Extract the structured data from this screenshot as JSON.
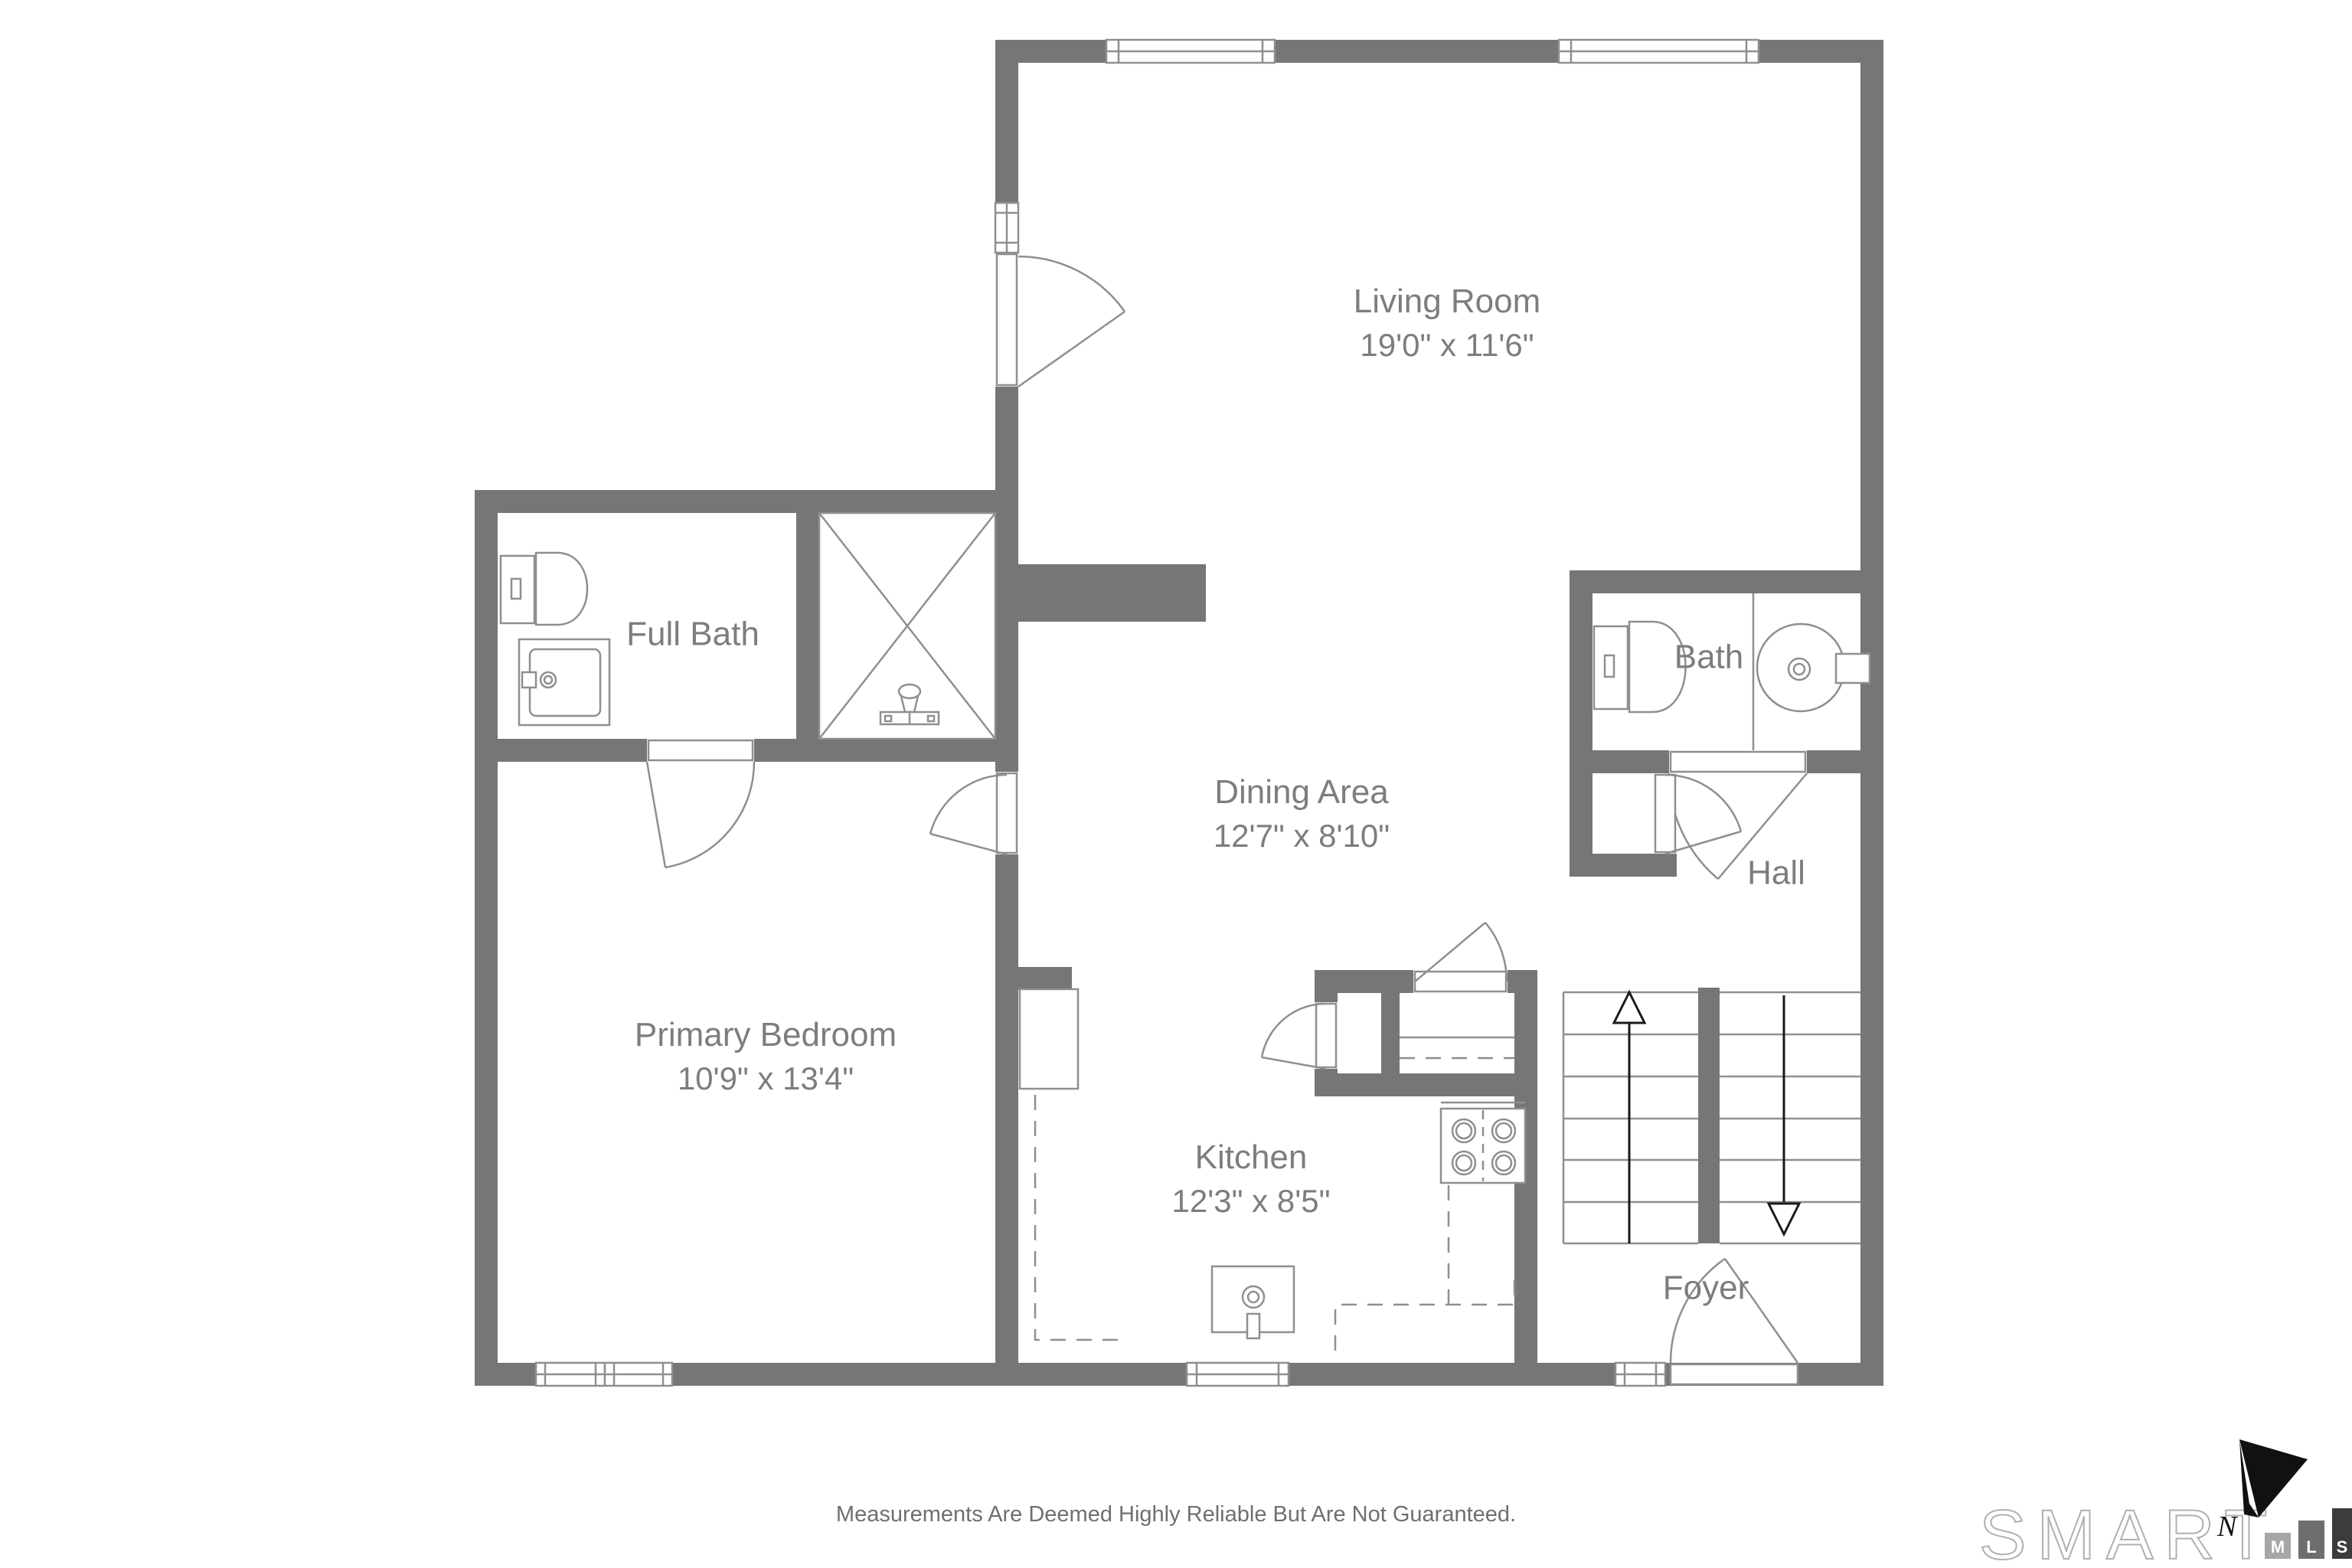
{
  "rooms": [
    {
      "id": "living-room",
      "name": "Living Room",
      "dims": "19'0\" x 11'6\""
    },
    {
      "id": "full-bath",
      "name": "Full Bath",
      "dims": ""
    },
    {
      "id": "dining-area",
      "name": "Dining Area",
      "dims": "12'7\" x 8'10\""
    },
    {
      "id": "bath",
      "name": "Bath",
      "dims": ""
    },
    {
      "id": "hall",
      "name": "Hall",
      "dims": ""
    },
    {
      "id": "primary-bedroom",
      "name": "Primary Bedroom",
      "dims": "10'9\" x 13'4\""
    },
    {
      "id": "kitchen",
      "name": "Kitchen",
      "dims": "12'3\" x 8'5\""
    },
    {
      "id": "foyer",
      "name": "Foyer",
      "dims": ""
    }
  ],
  "footer": {
    "disclaimer": "Measurements Are Deemed Highly Reliable But Are Not Guaranteed."
  },
  "logo": {
    "brand": "SMART",
    "letters": [
      "M",
      "L",
      "S"
    ],
    "north": "N"
  },
  "colors": {
    "wall": "#767676",
    "fixture_line": "#8f8f8f",
    "label_text": "#7d7d7d",
    "footer_text": "#6f6f6f",
    "arrow": "#1a1a1a",
    "logo_m_box": "#a6a6a6",
    "logo_l_box": "#6e6e6e",
    "logo_s_box": "#3c3c3c"
  }
}
